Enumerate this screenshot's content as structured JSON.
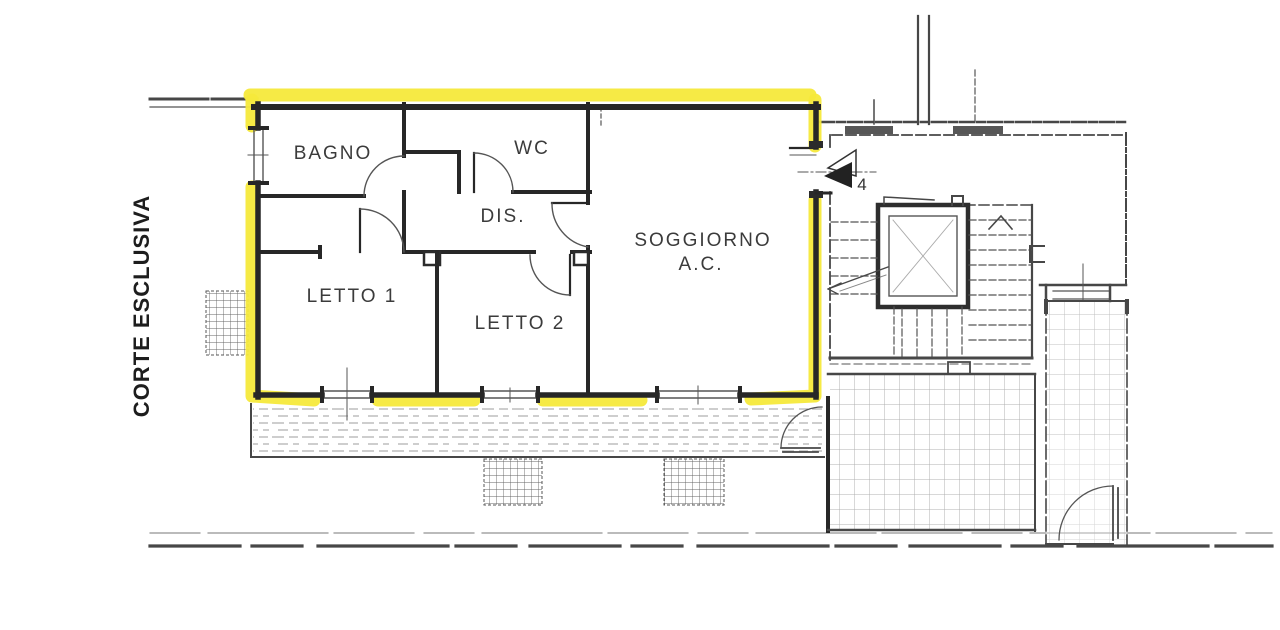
{
  "annotations": {
    "corte_label": "CORTE ESCLUSIVA",
    "entrance_number": "4"
  },
  "rooms": [
    {
      "id": "bagno",
      "label": "BAGNO"
    },
    {
      "id": "wc",
      "label": "WC"
    },
    {
      "id": "dis",
      "label": "DIS."
    },
    {
      "id": "soggiorno",
      "label": "SOGGIORNO",
      "sublabel": "A.C."
    },
    {
      "id": "letto1",
      "label": "LETTO 1"
    },
    {
      "id": "letto2",
      "label": "LETTO 2"
    }
  ],
  "colors": {
    "highlight": "#f5e93b",
    "wall": "#272727",
    "context": "#474747",
    "background": "#ffffff"
  }
}
